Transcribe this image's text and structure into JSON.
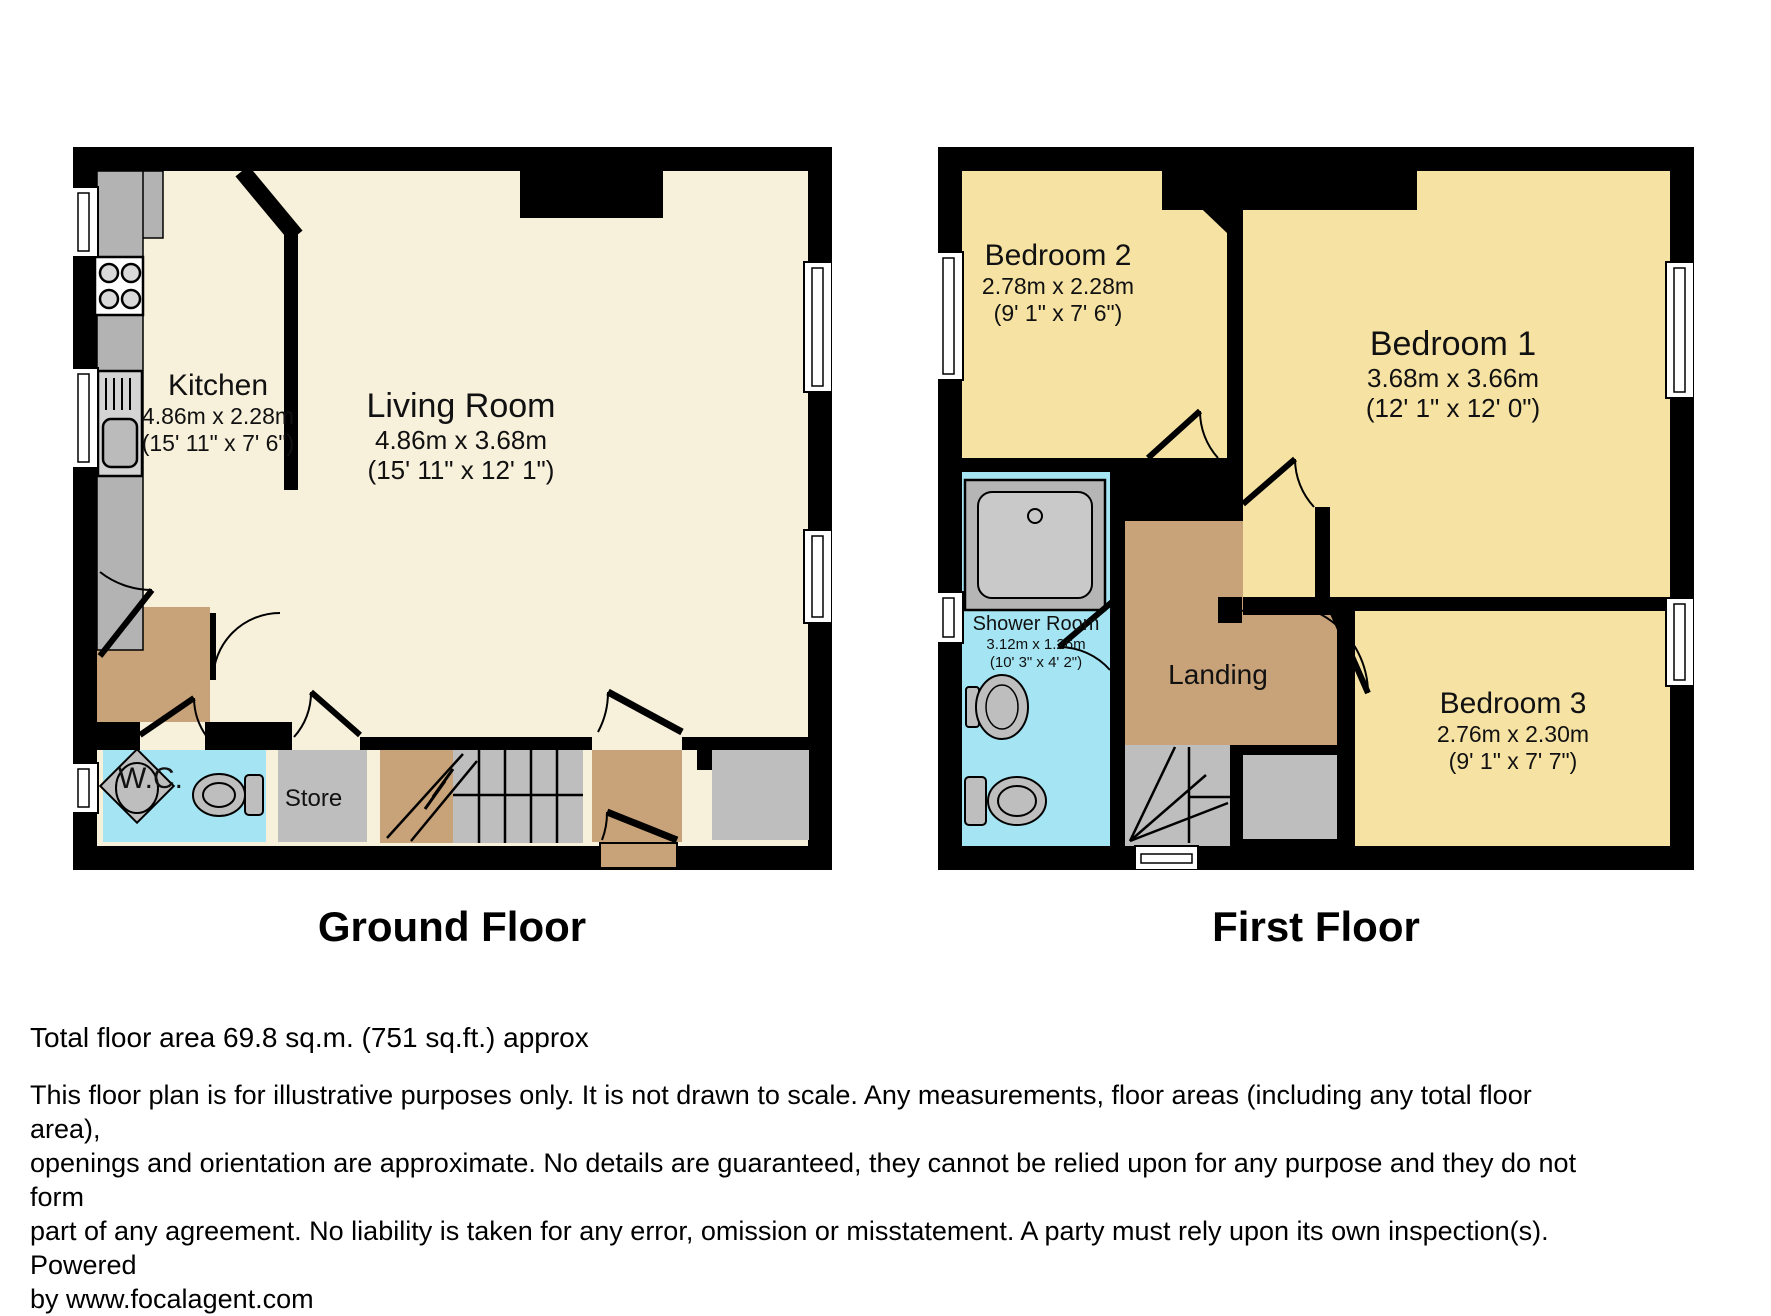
{
  "ground_floor": {
    "title": "Ground Floor",
    "rooms": {
      "kitchen": {
        "name": "Kitchen",
        "dim_metric": "4.86m x 2.28m",
        "dim_imperial": "(15' 11\" x 7' 6\")"
      },
      "living_room": {
        "name": "Living Room",
        "dim_metric": "4.86m x 3.68m",
        "dim_imperial": "(15' 11\" x 12' 1\")"
      },
      "wc": {
        "name": "W.C."
      },
      "store": {
        "name": "Store"
      }
    }
  },
  "first_floor": {
    "title": "First Floor",
    "rooms": {
      "bedroom2": {
        "name": "Bedroom 2",
        "dim_metric": "2.78m x 2.28m",
        "dim_imperial": "(9' 1\" x 7' 6\")"
      },
      "bedroom1": {
        "name": "Bedroom 1",
        "dim_metric": "3.68m x 3.66m",
        "dim_imperial": "(12' 1\" x 12' 0\")"
      },
      "bedroom3": {
        "name": "Bedroom 3",
        "dim_metric": "2.76m x 2.30m",
        "dim_imperial": "(9' 1\" x 7' 7\")"
      },
      "shower_room": {
        "name": "Shower Room",
        "dim_metric": "3.12m x 1.26m",
        "dim_imperial": "(10' 3\" x 4' 2\")"
      },
      "landing": {
        "name": "Landing"
      }
    }
  },
  "footer": {
    "total_area": "Total floor area 69.8 sq.m. (751 sq.ft.) approx",
    "disclaimer_lines": [
      "This floor plan is for illustrative purposes only. It is not drawn to scale. Any measurements, floor areas (including any total floor area),",
      "openings and orientation are approximate. No details are guaranteed, they cannot be relied upon for any purpose and they do not form",
      "part of any agreement. No liability is taken for any error, omission or misstatement. A party must rely upon its own inspection(s). Powered",
      "by www.focalagent.com"
    ]
  },
  "colors": {
    "wall": "#000000",
    "ground_floor_room": "#F7F0DB",
    "bedroom": "#F6E3A4",
    "wet_room": "#A5E5F3",
    "hall_landing": "#C8A278",
    "store_stairs": "#BEBEBE"
  }
}
